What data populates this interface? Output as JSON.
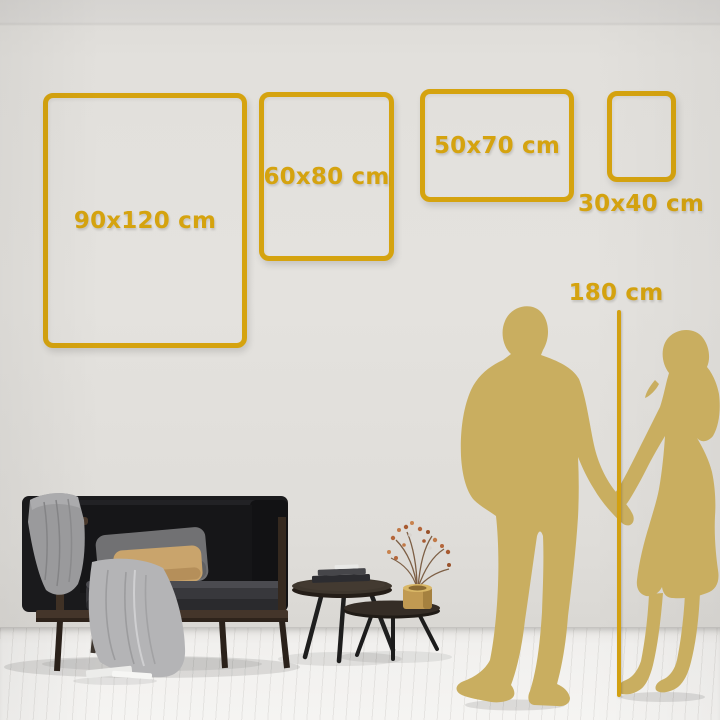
{
  "size_guide": {
    "frames": [
      {
        "label": "90x120 cm"
      },
      {
        "label": "60x80 cm"
      },
      {
        "label": "50x70 cm"
      },
      {
        "label": "30x40 cm"
      }
    ],
    "height_reference": {
      "label": "180 cm"
    }
  },
  "colors": {
    "accent_gold": "#D5A30F",
    "silhouette_gold": "#C9AE60",
    "wall": "#E2E0DC",
    "floor": "#F3F2F0"
  }
}
